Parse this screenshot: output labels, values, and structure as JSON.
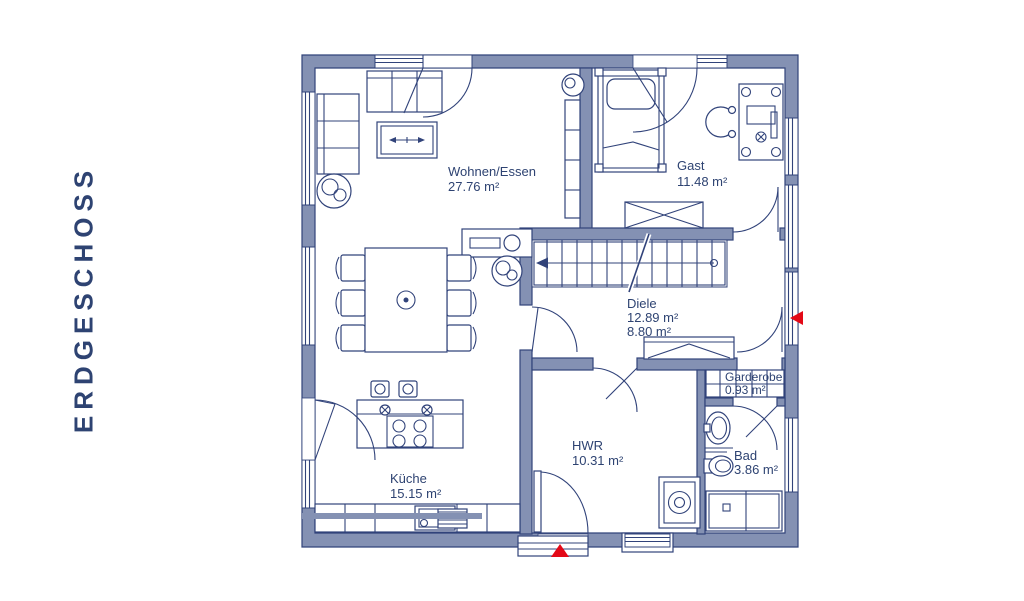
{
  "title": "ERDGESCHOSS",
  "plan": {
    "rooms": [
      {
        "name": "Wohnen/Essen",
        "area": "27.76 m²"
      },
      {
        "name": "Gast",
        "area": "11.48 m²"
      },
      {
        "name": "Diele",
        "area": "12.89 m²",
        "area2": "8.80 m²"
      },
      {
        "name": "Garderobe",
        "area": "0.93 m²"
      },
      {
        "name": "HWR",
        "area": "10.31 m²"
      },
      {
        "name": "Bad",
        "area": "3.86 m²"
      },
      {
        "name": "Küche",
        "area": "15.15 m²"
      }
    ],
    "colors": {
      "wall": "#8491B3",
      "line": "#31437A",
      "text": "#2E4372",
      "marker_red": "#E30917"
    }
  }
}
